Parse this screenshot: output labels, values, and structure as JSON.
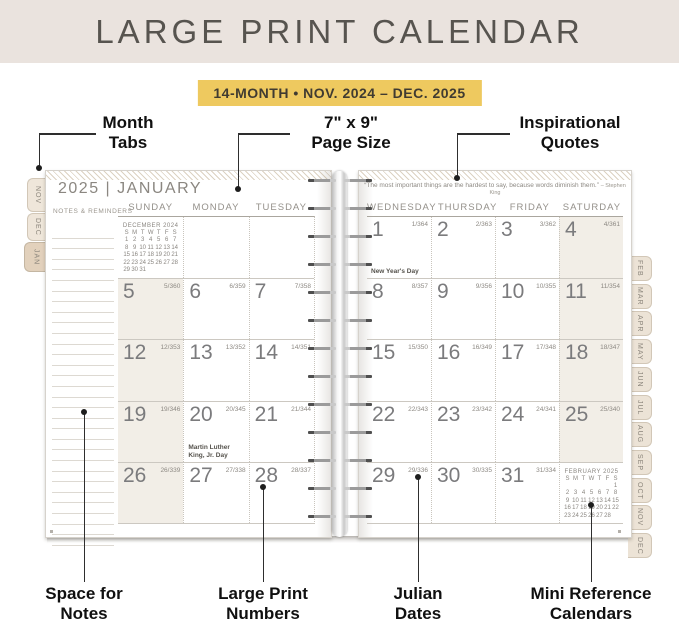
{
  "banner": {
    "title": "LARGE PRINT CALENDAR",
    "subtitle": "14-MONTH • NOV. 2024 – DEC. 2025"
  },
  "colors": {
    "banner_bg": "#EAE3DE",
    "accent_yellow": "#EEC95F",
    "weekend_shade": "#F2EEE7",
    "tab_tan": "#E2D1BC",
    "title_text": "#57544F",
    "calendar_text": "#8A8680"
  },
  "callouts": {
    "top": [
      {
        "id": "month-tabs",
        "lines": [
          "Month",
          "Tabs"
        ]
      },
      {
        "id": "page-size",
        "lines": [
          "7\" x 9\"",
          "Page Size"
        ]
      },
      {
        "id": "inspirational-quotes",
        "lines": [
          "Inspirational",
          "Quotes"
        ]
      }
    ],
    "bottom": [
      {
        "id": "space-for-notes",
        "lines": [
          "Space for",
          "Notes"
        ]
      },
      {
        "id": "large-print-numbers",
        "lines": [
          "Large Print",
          "Numbers"
        ]
      },
      {
        "id": "julian-dates",
        "lines": [
          "Julian",
          "Dates"
        ]
      },
      {
        "id": "mini-reference-calendars",
        "lines": [
          "Mini Reference",
          "Calendars"
        ]
      }
    ]
  },
  "book": {
    "left_tabs": [
      "NOV",
      "DEC",
      "JAN"
    ],
    "right_tabs": [
      "FEB",
      "MAR",
      "APR",
      "MAY",
      "JUN",
      "JUL",
      "AUG",
      "SEP",
      "OCT",
      "NOV",
      "DEC"
    ],
    "left_page": {
      "title": "2025 | JANUARY",
      "notes_header": "NOTES & REMINDERS",
      "day_headers": [
        "SUNDAY",
        "MONDAY",
        "TUESDAY"
      ],
      "weekend_column": 0,
      "weeks": [
        [
          {
            "mini": "december"
          },
          {},
          {}
        ],
        [
          {
            "date": "5",
            "julian": "5/360"
          },
          {
            "date": "6",
            "julian": "6/359"
          },
          {
            "date": "7",
            "julian": "7/358"
          }
        ],
        [
          {
            "date": "12",
            "julian": "12/353"
          },
          {
            "date": "13",
            "julian": "13/352"
          },
          {
            "date": "14",
            "julian": "14/351"
          }
        ],
        [
          {
            "date": "19",
            "julian": "19/346"
          },
          {
            "date": "20",
            "julian": "20/345",
            "holiday": "Martin Luther King, Jr. Day"
          },
          {
            "date": "21",
            "julian": "21/344"
          }
        ],
        [
          {
            "date": "26",
            "julian": "26/339"
          },
          {
            "date": "27",
            "julian": "27/338"
          },
          {
            "date": "28",
            "julian": "28/337"
          }
        ]
      ],
      "mini_calendar": {
        "title": "DECEMBER 2024",
        "day_letters": [
          "S",
          "M",
          "T",
          "W",
          "T",
          "F",
          "S"
        ],
        "weeks": [
          [
            "1",
            "2",
            "3",
            "4",
            "5",
            "6",
            "7"
          ],
          [
            "8",
            "9",
            "10",
            "11",
            "12",
            "13",
            "14"
          ],
          [
            "15",
            "16",
            "17",
            "18",
            "19",
            "20",
            "21"
          ],
          [
            "22",
            "23",
            "24",
            "25",
            "26",
            "27",
            "28"
          ],
          [
            "29",
            "30",
            "31",
            "",
            "",
            "",
            ""
          ]
        ]
      }
    },
    "right_page": {
      "quote": "“The most important things are the hardest to say, because words diminish them.”",
      "quote_attribution": "– Stephen King",
      "day_headers": [
        "WEDNESDAY",
        "THURSDAY",
        "FRIDAY",
        "SATURDAY"
      ],
      "weekend_column": 3,
      "weeks": [
        [
          {
            "date": "1",
            "julian": "1/364",
            "holiday": "New Year's Day"
          },
          {
            "date": "2",
            "julian": "2/363"
          },
          {
            "date": "3",
            "julian": "3/362"
          },
          {
            "date": "4",
            "julian": "4/361"
          }
        ],
        [
          {
            "date": "8",
            "julian": "8/357"
          },
          {
            "date": "9",
            "julian": "9/356"
          },
          {
            "date": "10",
            "julian": "10/355"
          },
          {
            "date": "11",
            "julian": "11/354"
          }
        ],
        [
          {
            "date": "15",
            "julian": "15/350"
          },
          {
            "date": "16",
            "julian": "16/349"
          },
          {
            "date": "17",
            "julian": "17/348"
          },
          {
            "date": "18",
            "julian": "18/347"
          }
        ],
        [
          {
            "date": "22",
            "julian": "22/343"
          },
          {
            "date": "23",
            "julian": "23/342"
          },
          {
            "date": "24",
            "julian": "24/341"
          },
          {
            "date": "25",
            "julian": "25/340"
          }
        ],
        [
          {
            "date": "29",
            "julian": "29/336"
          },
          {
            "date": "30",
            "julian": "30/335"
          },
          {
            "date": "31",
            "julian": "31/334"
          },
          {
            "mini": "february"
          }
        ]
      ],
      "mini_calendar": {
        "title": "FEBRUARY 2025",
        "day_letters": [
          "S",
          "M",
          "T",
          "W",
          "T",
          "F",
          "S"
        ],
        "weeks": [
          [
            "",
            "",
            "",
            "",
            "",
            "",
            "1"
          ],
          [
            "2",
            "3",
            "4",
            "5",
            "6",
            "7",
            "8"
          ],
          [
            "9",
            "10",
            "11",
            "12",
            "13",
            "14",
            "15"
          ],
          [
            "16",
            "17",
            "18",
            "19",
            "20",
            "21",
            "22"
          ],
          [
            "23",
            "24",
            "25",
            "26",
            "27",
            "28",
            ""
          ]
        ]
      }
    }
  }
}
